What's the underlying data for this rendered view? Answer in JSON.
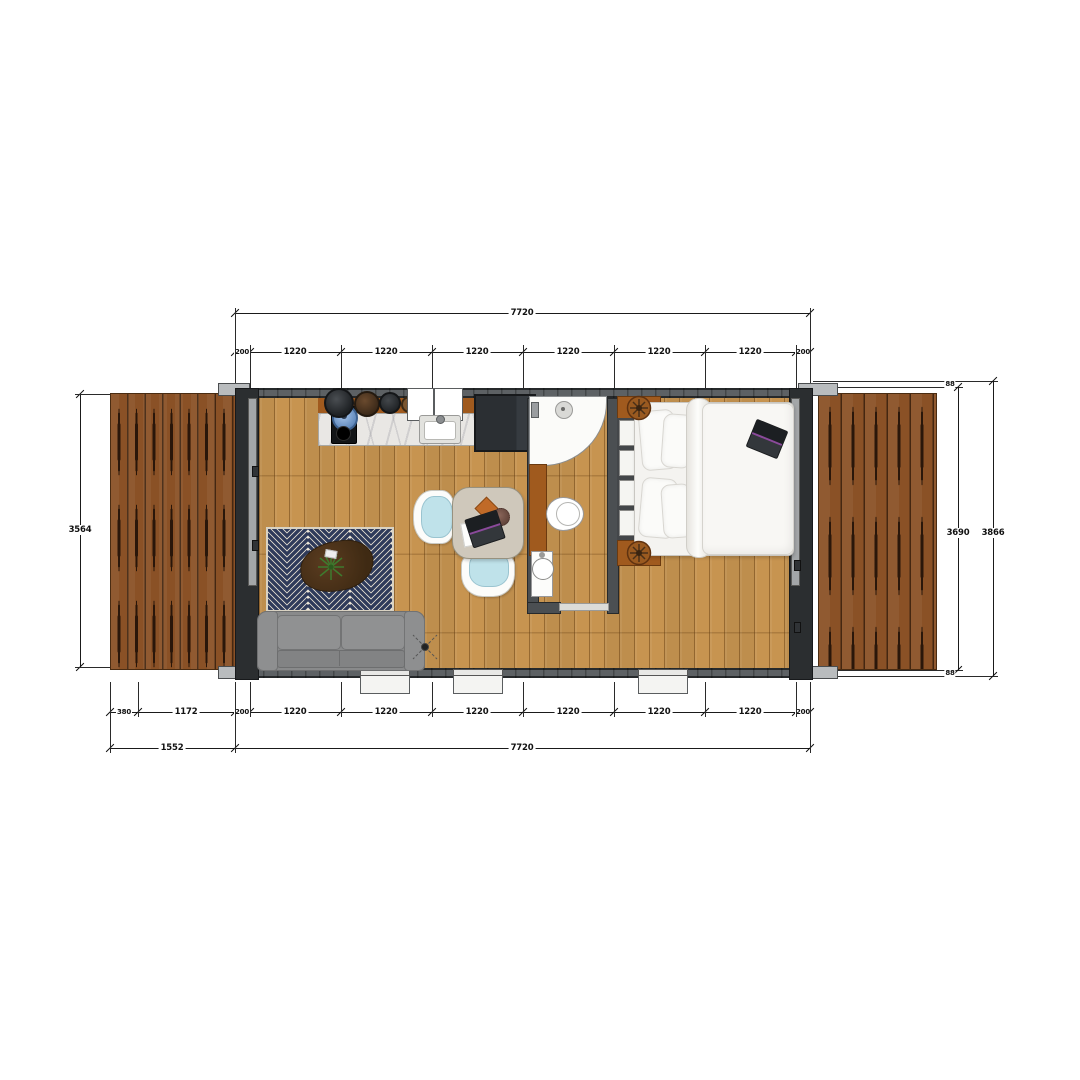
{
  "dimensions": {
    "top": {
      "total": "7720",
      "chain": [
        "200",
        "1220",
        "1220",
        "1220",
        "1220",
        "1220",
        "1220",
        "200"
      ]
    },
    "bottom": {
      "chain": [
        "380",
        "1172",
        "200",
        "1220",
        "1220",
        "1220",
        "1220",
        "1220",
        "1220",
        "200"
      ],
      "deck_total": "1552",
      "total": "7720"
    },
    "left": {
      "deck_height": "3564"
    },
    "right": {
      "inner_height": "3690",
      "outer_height": "3866",
      "top_offset": "88",
      "bottom_offset": "88"
    }
  },
  "colors": {
    "wall": "#4b4f52",
    "floor_wood": "#c79450",
    "deck_wood": "#8a5126",
    "rug_navy": "#2e3a5a",
    "rug_cream": "#ece5d6",
    "sofa_gray": "#898a8b",
    "chair_cushion_blue": "#bfe2ea",
    "cabinet_wood": "#a05a1e",
    "marble": "#e9e7e4",
    "laptop_accent_purple": "#8a4a9a",
    "dimension_ink": "#1a1a1a"
  }
}
